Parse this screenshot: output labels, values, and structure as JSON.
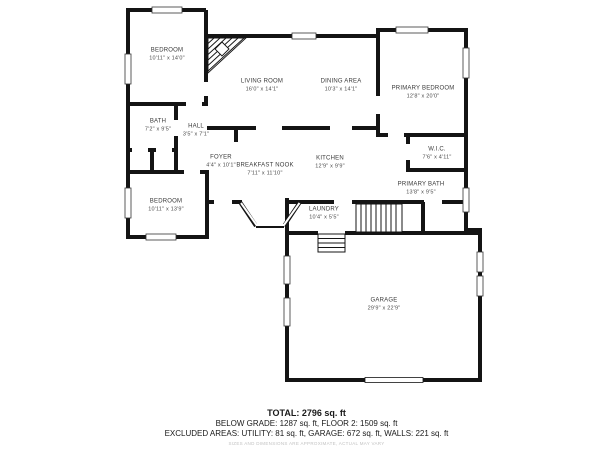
{
  "rooms": [
    {
      "name": "BEDROOM",
      "dims": "10'11\" x 14'0\""
    },
    {
      "name": "LIVING ROOM",
      "dims": "16'0\" x 14'1\""
    },
    {
      "name": "DINING AREA",
      "dims": "10'3\" x 14'1\""
    },
    {
      "name": "PRIMARY BEDROOM",
      "dims": "12'8\" x 20'0\""
    },
    {
      "name": "BATH",
      "dims": "7'2\" x 9'5\""
    },
    {
      "name": "HALL",
      "dims": "3'5\" x 7'1\""
    },
    {
      "name": "FOYER",
      "dims": "4'4\" x 10'1\""
    },
    {
      "name": "BREAKFAST NOOK",
      "dims": "7'11\" x 11'10\""
    },
    {
      "name": "KITCHEN",
      "dims": "12'9\" x 9'9\""
    },
    {
      "name": "W.I.C.",
      "dims": "7'6\" x 4'11\""
    },
    {
      "name": "PRIMARY BATH",
      "dims": "13'8\" x 9'5\""
    },
    {
      "name": "BEDROOM",
      "dims": "10'11\" x 13'9\""
    },
    {
      "name": "LAUNDRY",
      "dims": "10'4\" x 5'5\""
    },
    {
      "name": "GARAGE",
      "dims": "29'9\" x 22'9\""
    }
  ],
  "summary": {
    "total": "TOTAL: 2796 sq. ft",
    "floors": "BELOW GRADE: 1287 sq. ft, FLOOR 2: 1509 sq. ft",
    "excluded": "EXCLUDED AREAS: UTILITY: 81 sq. ft, GARAGE: 672 sq. ft, WALLS: 221 sq. ft",
    "disclaimer": "SIZES AND DIMENSIONS ARE APPROXIMATE, ACTUAL MAY VARY"
  },
  "colors": {
    "wall": "#141414",
    "text": "#3a3a3a",
    "disclaimer": "#c2c2c2"
  }
}
